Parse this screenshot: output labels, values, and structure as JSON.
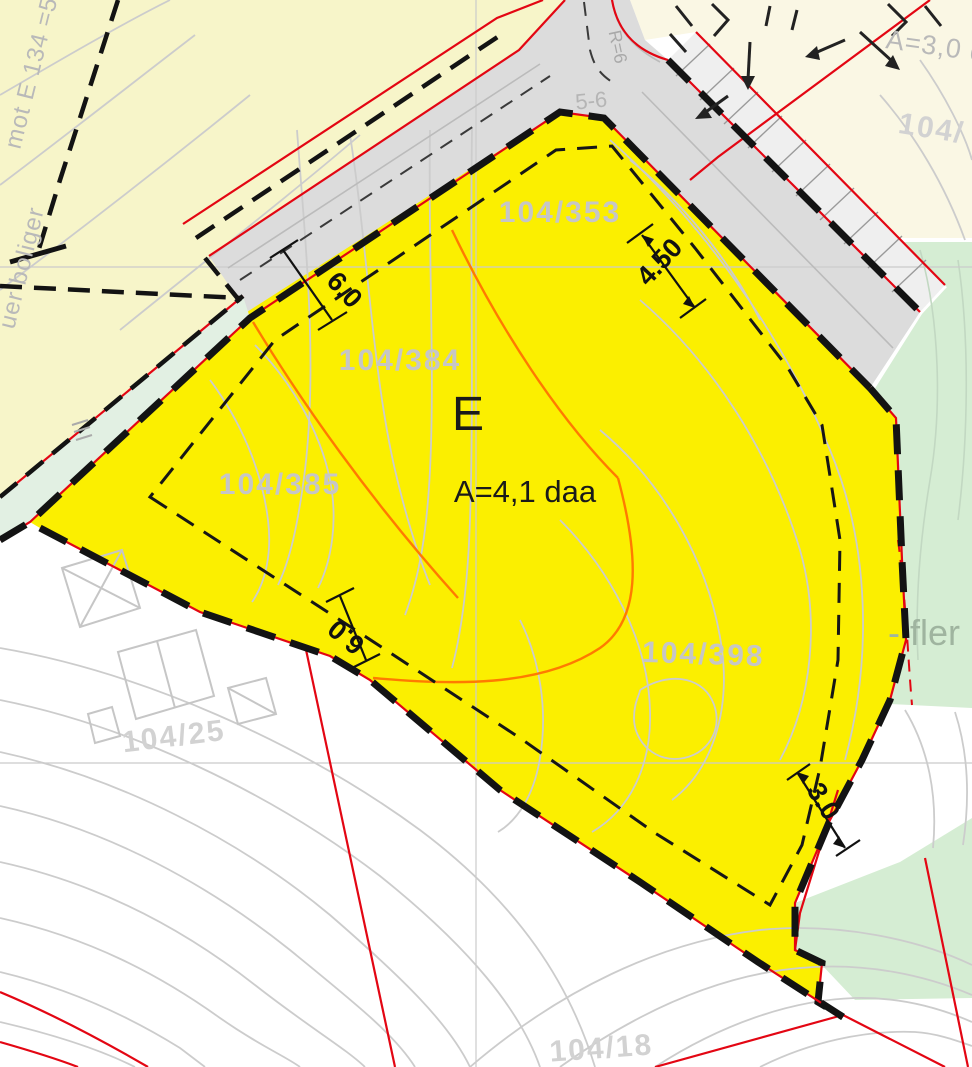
{
  "plan": {
    "zone": {
      "code": "E",
      "area_label": "A=4,1 daa"
    },
    "parcels": {
      "p353": "104/353",
      "p384": "104/384",
      "p385": "104/385",
      "p398": "104/398",
      "p25": "104/25",
      "p18": "104/18",
      "p_top_right": "104/"
    },
    "areas": {
      "top_right": "A=3,0 d"
    },
    "margin_notes": {
      "left_upper": "mot E 134 =5",
      "left_lower": "uer boliger",
      "right": "- fler"
    },
    "road_annotations": {
      "radius": "R=6",
      "profile": "5-6"
    },
    "dimensions": {
      "road_width": "6.0",
      "building_offset": "6.0",
      "crossing_width": "4.50",
      "right_offset": "3.0"
    },
    "colors": {
      "zone_fill": "#FBEF00",
      "residential_fill": "#F7F5C9",
      "cream_fill": "#FAF7E4",
      "road_fill": "#DCDCDC",
      "green_fill": "#D5EDD3",
      "mint_fill": "#E2F0E3",
      "boundary_red": "#E30613",
      "parcel_line_orange": "#FF7A00",
      "contour_gray": "#CCCCCC",
      "label_gray": "#C6C6C6"
    }
  }
}
